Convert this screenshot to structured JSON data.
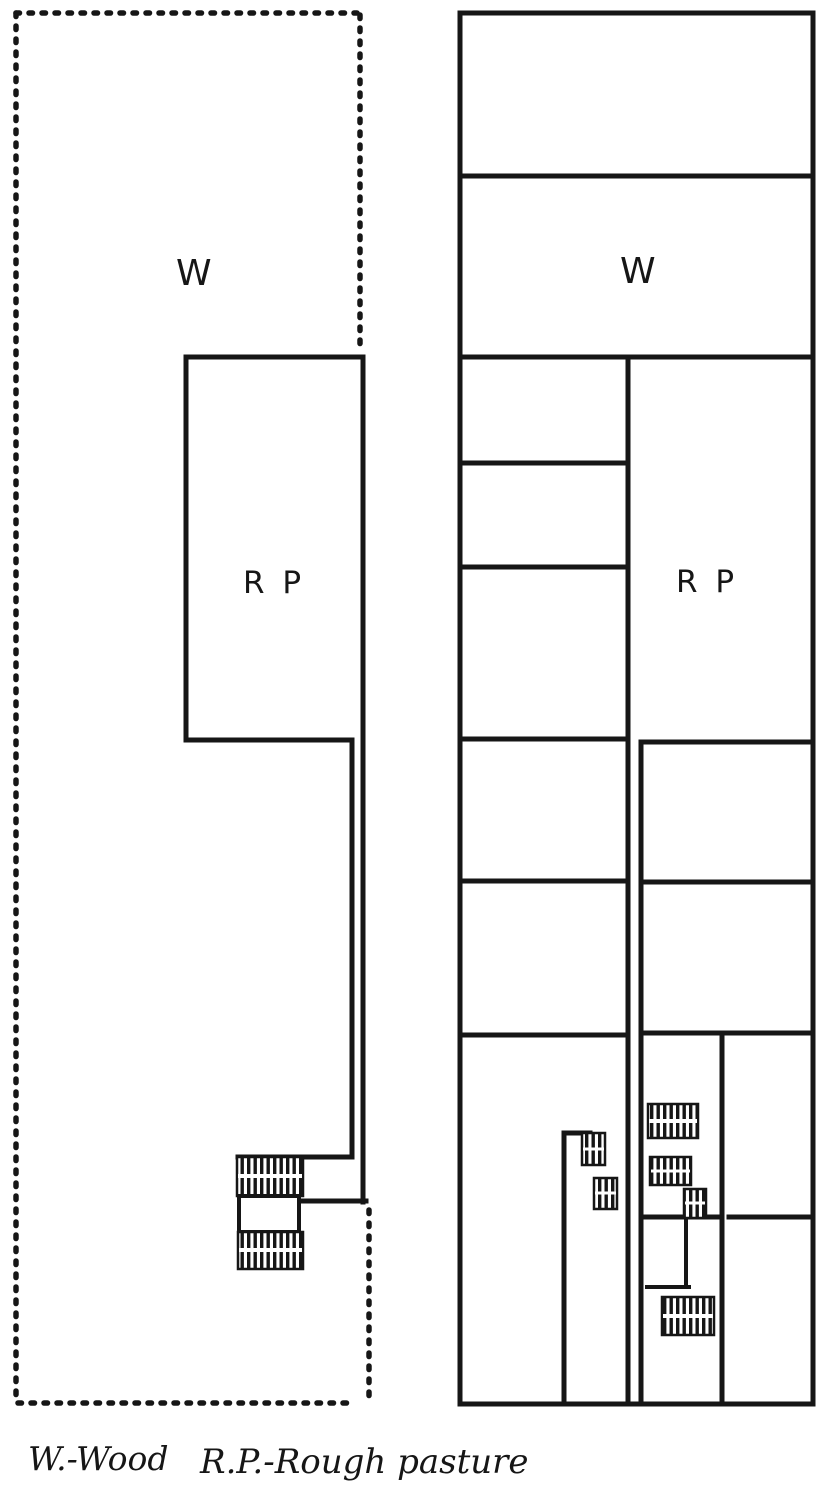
{
  "page": {
    "kind": "scanned hand-drawn land-use sketch map",
    "colors": {
      "ink": "#161616",
      "paper": "#ffffff"
    }
  },
  "map": {
    "left_parcel": {
      "boundary_style": "dotted",
      "wood_label": "W",
      "rough_pasture_label": "R P"
    },
    "right_parcel": {
      "boundary_style": "solid",
      "wood_label": "W",
      "rough_pasture_label": "R P"
    }
  },
  "legend": {
    "wood_entry": "W.-Wood",
    "rough_pasture_entry": "R.P.-Rough pasture"
  }
}
